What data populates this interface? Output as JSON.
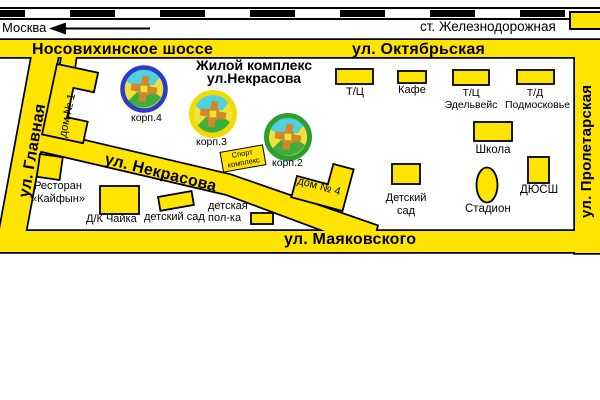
{
  "railway": {
    "moscow": "Москва",
    "station": "ст. Железнодорожная"
  },
  "roads": {
    "nosovikhinskoe": "Носовихинское шоссе",
    "oktyabrskaya": "ул. Октябрьская",
    "glavnaya": "ул. Главная",
    "proletarskaya": "ул. Пролетарская",
    "nekrasova": "ул. Некрасова",
    "mayakovskogo": "ул. Маяковского"
  },
  "title": "Жилой комплекс\nул.Некрасова",
  "buildings": {
    "dom1": "дом № 1",
    "korp4": "корп.4",
    "korp3": "корп.3",
    "korp2": "корп.2",
    "sport": "Спорт\nкомплекс",
    "dom4": "дом № 4",
    "restoran": "Ресторан\n«Кайфын»",
    "dk_chaika": "Д/К Чайка",
    "detsky_sad_left": "детский сад",
    "detskaya_polka": "детская\nпол-ка",
    "tc1": "Т/Ц",
    "kafe": "Кафе",
    "tc_edelweis": "Т/Ц\nЭдельвейс",
    "td_podmoskovye": "Т/Д\nПодмосковье",
    "shkola": "Школа",
    "detsky_sad_right": "Детский\nсад",
    "stadion": "Стадион",
    "dyussh": "ДЮСШ"
  },
  "colors": {
    "road_yellow": "#ffe400",
    "outline_black": "#000000",
    "ring_korp4_blue": "#2a3cc8",
    "ring_korp3_yellow": "#f2dc00",
    "ring_korp2_green": "#2f9e2f",
    "courtyard_yellow": "#f2e13c",
    "courtyard_cyan": "#4fd2e0",
    "courtyard_green": "#3cae3c",
    "courtyard_orange": "#d4862a"
  }
}
